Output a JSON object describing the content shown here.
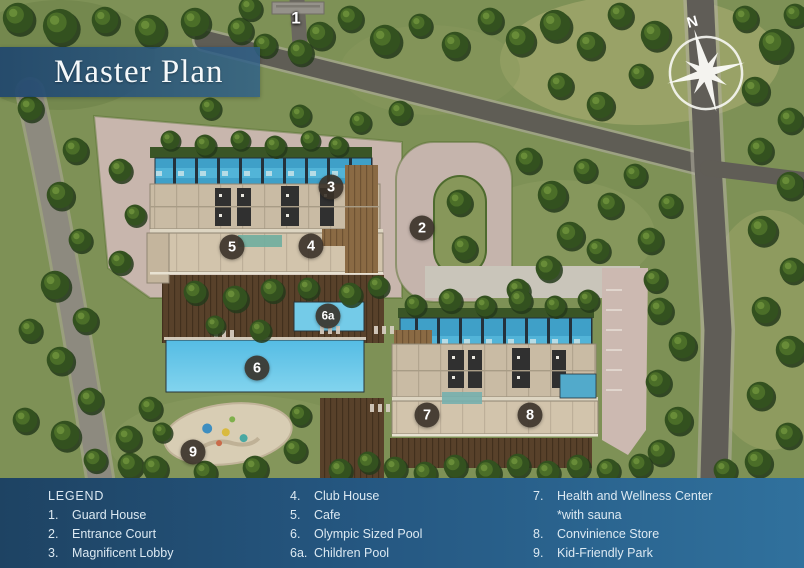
{
  "banner": {
    "title": "Master Plan"
  },
  "compass": {
    "label": "N"
  },
  "map": {
    "markers": [
      {
        "id": "1",
        "label": "1"
      },
      {
        "id": "2",
        "label": "2"
      },
      {
        "id": "3",
        "label": "3"
      },
      {
        "id": "4",
        "label": "4"
      },
      {
        "id": "5",
        "label": "5"
      },
      {
        "id": "6",
        "label": "6"
      },
      {
        "id": "6a",
        "label": "6a"
      },
      {
        "id": "7",
        "label": "7"
      },
      {
        "id": "8",
        "label": "8"
      },
      {
        "id": "9",
        "label": "9"
      }
    ]
  },
  "legend": {
    "title": "LEGEND",
    "columns": [
      {
        "items": [
          {
            "num": "1.",
            "label": "Guard House"
          },
          {
            "num": "2.",
            "label": "Entrance Court"
          },
          {
            "num": "3.",
            "label": "Magnificent Lobby"
          }
        ]
      },
      {
        "items": [
          {
            "num": "4.",
            "label": "Club House"
          },
          {
            "num": "5.",
            "label": "Cafe"
          },
          {
            "num": "6.",
            "label": "Olympic Sized Pool"
          },
          {
            "num": "6a.",
            "label": "Children Pool"
          }
        ]
      },
      {
        "items": [
          {
            "num": "7.",
            "label": "Health and Wellness Center"
          },
          {
            "num": "",
            "label": "*with sauna"
          },
          {
            "num": "8.",
            "label": "Convinience Store"
          },
          {
            "num": "9.",
            "label": "Kid-Friendly Park"
          }
        ]
      }
    ]
  },
  "colors": {
    "legend_gradient_left": "#1e4363",
    "legend_gradient_right": "#30719d",
    "banner_blue": "#2d5f89",
    "pool_blue": "#5fc0e6",
    "grass_green": "#7e9156",
    "road_gray": "#5f5d55",
    "paver_pink": "#c8b6ad",
    "deck_brown": "#58412a",
    "building_tan": "#c9bba4",
    "marker_dark": "#383128"
  }
}
